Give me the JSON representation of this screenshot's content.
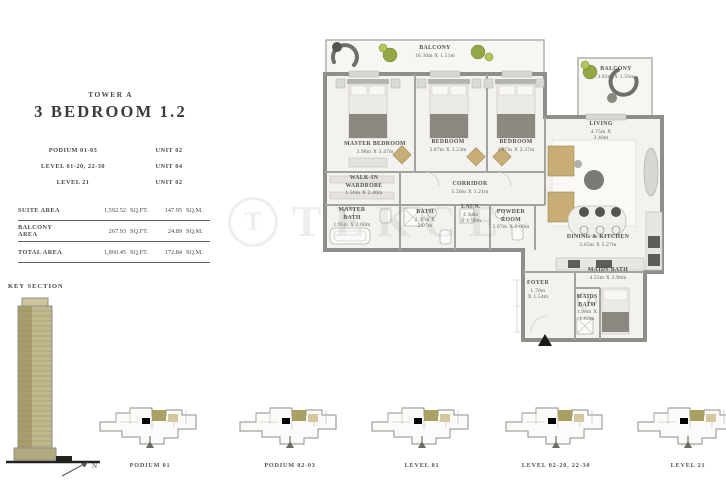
{
  "header": {
    "tower": "TOWER A",
    "title": "3 BEDROOM 1.2"
  },
  "unit_table": [
    {
      "level": "PODIUM 01-03",
      "unit": "UNIT 02"
    },
    {
      "level": "LEVEL 01-20, 22-30",
      "unit": "UNIT 04"
    },
    {
      "level": "LEVEL 21",
      "unit": "UNIT 02"
    }
  ],
  "area_table": [
    {
      "label": "SUITE AREA",
      "sqft": "1,592.52",
      "sqft_unit": "SQ.FT.",
      "sqm": "147.95",
      "sqm_unit": "SQ.M."
    },
    {
      "label": "BALCONY AREA",
      "sqft": "267.93",
      "sqft_unit": "SQ.FT.",
      "sqm": "24.89",
      "sqm_unit": "SQ.M."
    },
    {
      "label": "TOTAL AREA",
      "sqft": "1,860.45",
      "sqft_unit": "SQ.FT.",
      "sqm": "172.84",
      "sqm_unit": "SQ.M."
    }
  ],
  "key_section": {
    "label": "KEY SECTION",
    "north_label": "N"
  },
  "watermark": {
    "logo": "T",
    "text": "TEKCE"
  },
  "plan": {
    "rooms": [
      {
        "id": "balcony-top",
        "lines": [
          "BALCONY",
          "10.30m X 1.51m"
        ],
        "x": 435,
        "y": 45
      },
      {
        "id": "master-bedroom",
        "lines": [
          "MASTER BEDROOM",
          "3.98m X 3.47m"
        ],
        "x": 375,
        "y": 141
      },
      {
        "id": "bedroom-2",
        "lines": [
          "BEDROOM",
          "3.87m X 3.23m"
        ],
        "x": 448,
        "y": 139
      },
      {
        "id": "bedroom-3",
        "lines": [
          "BEDROOM",
          "3.87m X 3.37m"
        ],
        "x": 516,
        "y": 139
      },
      {
        "id": "walk-in-wardrobe",
        "lines": [
          "WALK-IN",
          "WARDROBE",
          "1.56m X 2.40m"
        ],
        "x": 364,
        "y": 175
      },
      {
        "id": "corridor",
        "lines": [
          "CORRIDOR",
          "5.30m X 1.21m"
        ],
        "x": 470,
        "y": 181
      },
      {
        "id": "master-bath",
        "lines": [
          "MASTER",
          "BATH",
          "1.95m X 2.60m"
        ],
        "x": 352,
        "y": 207
      },
      {
        "id": "bath",
        "lines": [
          "BATH",
          "2.37m X",
          "2.07m"
        ],
        "x": 425,
        "y": 209
      },
      {
        "id": "laundry",
        "lines": [
          "LAUN.",
          "1.44m",
          "X 1.90m"
        ],
        "x": 471,
        "y": 204
      },
      {
        "id": "powder-room",
        "lines": [
          "POWDER",
          "ROOM",
          "2.07m X 2.00m"
        ],
        "x": 511,
        "y": 209
      },
      {
        "id": "living",
        "lines": [
          "LIVING",
          "4.75m X",
          "3.40m"
        ],
        "x": 601,
        "y": 121
      },
      {
        "id": "balcony-right",
        "lines": [
          "BALCONY",
          "3.82m X 1.56m"
        ],
        "x": 616,
        "y": 66
      },
      {
        "id": "dining-kitchen",
        "lines": [
          "DINING & KITCHEN",
          "3.65m X 5.27m"
        ],
        "x": 598,
        "y": 234
      },
      {
        "id": "maids-bath-upper",
        "lines": [
          "MAIDS BATH",
          "4.55m X 2.96m"
        ],
        "x": 608,
        "y": 267
      },
      {
        "id": "foyer",
        "lines": [
          "FOYER",
          "1.70m",
          "X 1.54m"
        ],
        "x": 538,
        "y": 280
      },
      {
        "id": "maids-bath",
        "lines": [
          "MAIDS",
          "BATH",
          "1.98m X",
          "1.63m"
        ],
        "x": 587,
        "y": 294
      }
    ]
  },
  "keyplans": [
    {
      "label": "PODIUM 01",
      "cx": 150
    },
    {
      "label": "PODIUM 02-03",
      "cx": 290
    },
    {
      "label": "LEVEL 01",
      "cx": 422
    },
    {
      "label": "LEVEL 02-20, 22-30",
      "cx": 556
    },
    {
      "label": "LEVEL 21",
      "cx": 688
    }
  ]
}
